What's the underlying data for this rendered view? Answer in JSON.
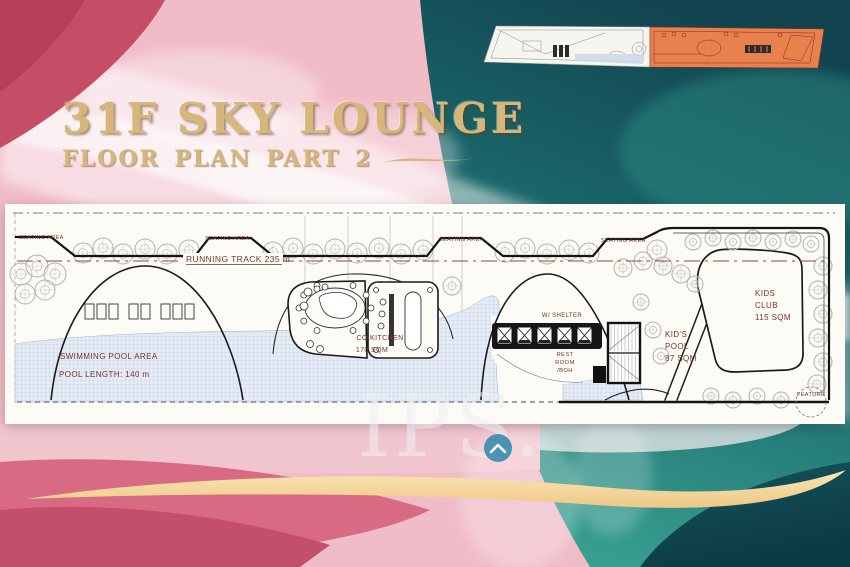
{
  "slide": {
    "title": "31F SKY LOUNGE",
    "subtitle": "FLOOR PLAN  PART 2"
  },
  "minimap": {
    "highlight_color": "#e8814e"
  },
  "plan": {
    "seating_labels": [
      "SEATING AREA",
      "SEATING AREA",
      "SEATING AREA",
      "SEATING AREA"
    ],
    "running_track_label": "RUNNING TRACK 235 m",
    "pool_label_line1": "SWIMMING POOL AREA",
    "pool_label_line2": "POOL LENGTH: 140 m",
    "kitchen_label_line1": "CO KITCHEN",
    "kitchen_label_line2": "170 SQM",
    "shelter_label": "W/ SHELTER",
    "restroom_lines": [
      "REST",
      "ROOM",
      "/BOH"
    ],
    "kids_pool_lines": [
      "KID'S",
      "POOL",
      "87 SQM"
    ],
    "kids_club_lines": [
      "KIDS",
      "CLUB",
      "115 SQM"
    ],
    "feature_label": "FEATURE"
  },
  "watermark": {
    "text": "IPS."
  },
  "colors": {
    "gold": "#d7b67c",
    "plan_label": "#7a3526",
    "pool_fill": "#e6ecf6",
    "watermark_circle": "#3d8cae"
  }
}
